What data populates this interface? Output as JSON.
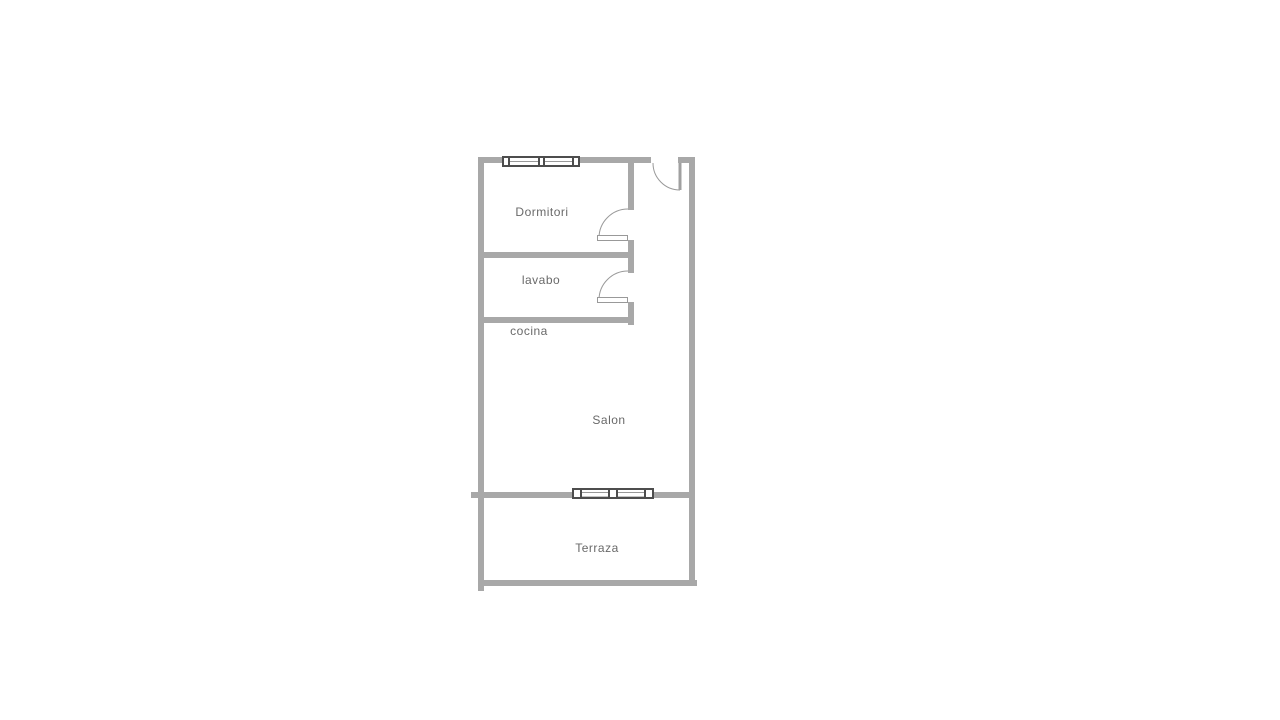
{
  "floorplan": {
    "title": "apartment-floor-plan",
    "rooms": [
      {
        "id": "dormitori",
        "label": "Dormitori"
      },
      {
        "id": "lavabo",
        "label": "lavabo"
      },
      {
        "id": "cocina",
        "label": "cocina"
      },
      {
        "id": "salon",
        "label": "Salon"
      },
      {
        "id": "terraza",
        "label": "Terraza"
      }
    ],
    "features": {
      "windows": [
        "dormitori-window",
        "salon-terraza-sliding-window"
      ],
      "doors": [
        "entrance-door",
        "dormitori-door",
        "lavabo-door"
      ]
    },
    "colors": {
      "wall": "#a8a8a8",
      "window_frame": "#4d4d4d",
      "door_arc": "#999999",
      "label_text": "#696969",
      "background": "#ffffff"
    }
  }
}
